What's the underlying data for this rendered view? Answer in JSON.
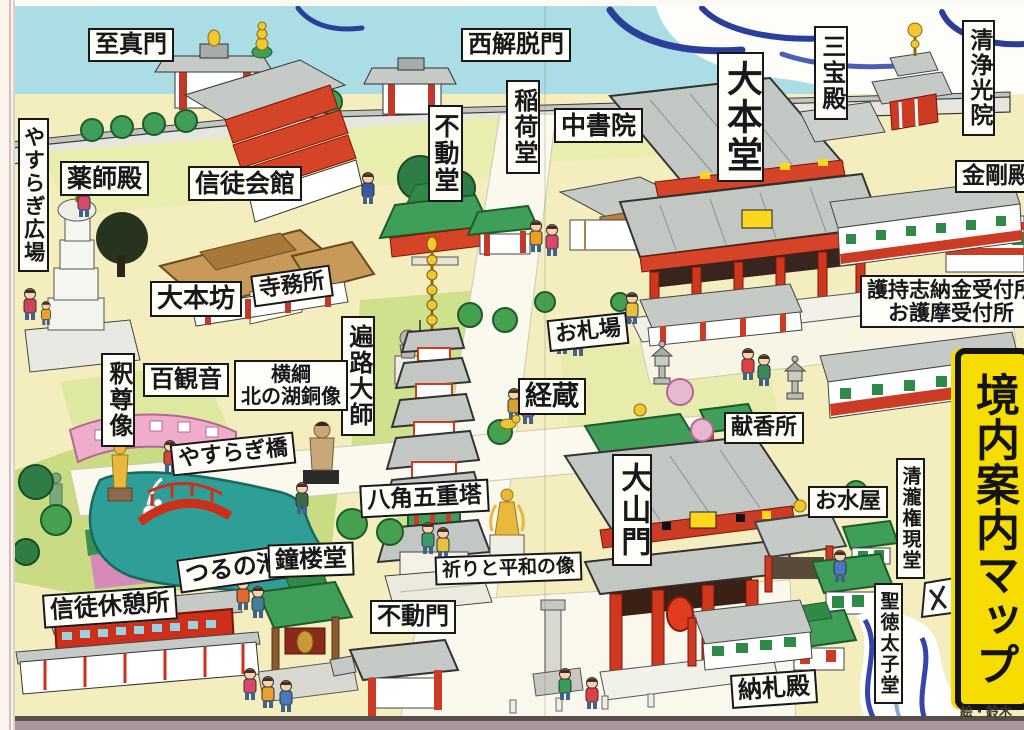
{
  "banner": {
    "text": "境内案内マップ",
    "bg_color": "#f6dc00"
  },
  "credit": "絵・鈴木",
  "colors": {
    "sky_blue": "#aadde6",
    "cloud_navy": "#2b3f9a",
    "ground_cream": "#f4edbe",
    "lawn_green": "#e7ebab",
    "dark_lawn": "#cfe18c",
    "pond_teal": "#2f9e96",
    "building_red": "#d0381e",
    "roof_gray": "#c3c7c3",
    "temple_green_roof": "#3f9e57",
    "wood_tan": "#c89a5a",
    "gold": "#f2c832",
    "banner_yellow": "#f6dc00",
    "pink_corridor": "#efaccb",
    "bottom_strip_mauve": "#a9969c"
  },
  "labels": [
    {
      "id": "shijinmon",
      "t": "至真門",
      "x": 88,
      "y": 28,
      "o": "h",
      "s": 24
    },
    {
      "id": "nishi-gedatsumon",
      "t": "西解脱門",
      "x": 461,
      "y": 28,
      "o": "h",
      "s": 24
    },
    {
      "id": "sanpoden",
      "t": "三宝殿",
      "x": 814,
      "y": 26,
      "o": "v",
      "s": 24
    },
    {
      "id": "shojokoin",
      "t": "清浄光院",
      "x": 962,
      "y": 20,
      "o": "v",
      "s": 23
    },
    {
      "id": "yasuragi-hiroba",
      "t": "やすらぎ広場",
      "x": 18,
      "y": 118,
      "o": "v",
      "s": 21
    },
    {
      "id": "yakushiden",
      "t": "薬師殿",
      "x": 60,
      "y": 161,
      "o": "h",
      "s": 25
    },
    {
      "id": "shintokaikan",
      "t": "信徒会館",
      "x": 188,
      "y": 166,
      "o": "h",
      "s": 25
    },
    {
      "id": "fudodo",
      "t": "不動堂",
      "x": 428,
      "y": 105,
      "o": "v",
      "s": 25
    },
    {
      "id": "inarido",
      "t": "稲荷堂",
      "x": 506,
      "y": 80,
      "o": "v",
      "s": 24
    },
    {
      "id": "chushoin",
      "t": "中書院",
      "x": 554,
      "y": 108,
      "o": "h",
      "s": 25
    },
    {
      "id": "daihondo",
      "t": "大本堂",
      "x": 717,
      "y": 52,
      "o": "v",
      "s": 36
    },
    {
      "id": "kongoden",
      "t": "金剛殿",
      "x": 955,
      "y": 160,
      "o": "h",
      "s": 23
    },
    {
      "id": "daihonbo",
      "t": "大本坊",
      "x": 150,
      "y": 281,
      "o": "h",
      "s": 26
    },
    {
      "id": "jimusho",
      "t": "寺務所",
      "x": 252,
      "y": 270,
      "o": "h",
      "s": 22,
      "r": -8
    },
    {
      "id": "uketsukesho",
      "lines": [
        "護持志納金受付所",
        "お護摩受付所"
      ],
      "x": 860,
      "y": 275,
      "o": "h",
      "s": 21
    },
    {
      "id": "henro-daishi",
      "t": "遍路大師",
      "x": 341,
      "y": 316,
      "o": "v",
      "s": 24
    },
    {
      "id": "ofudaba",
      "t": "お札場",
      "x": 548,
      "y": 316,
      "o": "h",
      "s": 22,
      "r": -6
    },
    {
      "id": "shakusonzo",
      "t": "釈尊像",
      "x": 101,
      "y": 353,
      "o": "v",
      "s": 24
    },
    {
      "id": "hyakkannon",
      "t": "百観音",
      "x": 143,
      "y": 363,
      "o": "h",
      "s": 24
    },
    {
      "id": "yokozuna-kitanoumi",
      "lines": [
        "横綱",
        "北の湖銅像"
      ],
      "x": 234,
      "y": 360,
      "o": "h",
      "s": 20
    },
    {
      "id": "kyozo",
      "t": "経蔵",
      "x": 518,
      "y": 378,
      "o": "h",
      "s": 27
    },
    {
      "id": "kenkosho",
      "t": "献香所",
      "x": 724,
      "y": 412,
      "o": "h",
      "s": 22
    },
    {
      "id": "yasuragibashi",
      "t": "やすらぎ橋",
      "x": 171,
      "y": 438,
      "o": "h",
      "s": 22,
      "r": -6
    },
    {
      "id": "hakkaku-gojunoto",
      "t": "八角五重塔",
      "x": 360,
      "y": 482,
      "o": "h",
      "s": 23,
      "r": -3
    },
    {
      "id": "daisanmon",
      "t": "大山門",
      "x": 612,
      "y": 454,
      "o": "v",
      "s": 30
    },
    {
      "id": "omizuya",
      "t": "お水屋",
      "x": 808,
      "y": 486,
      "o": "h",
      "s": 22
    },
    {
      "id": "seiryu-gongendo",
      "t": "清瀧権現堂",
      "x": 896,
      "y": 458,
      "o": "v",
      "s": 19
    },
    {
      "id": "tsurunoike",
      "t": "つるの池",
      "x": 178,
      "y": 552,
      "o": "h",
      "s": 24,
      "r": -8
    },
    {
      "id": "shorodo",
      "t": "鐘楼堂",
      "x": 268,
      "y": 543,
      "o": "h",
      "s": 24,
      "r": -2
    },
    {
      "id": "inori-to-heiwa-no-zo",
      "t": "祈りと平和の像",
      "x": 435,
      "y": 554,
      "o": "h",
      "s": 19,
      "r": -2
    },
    {
      "id": "shinto-kyukeisho",
      "t": "信徒休憩所",
      "x": 43,
      "y": 590,
      "o": "h",
      "s": 24,
      "r": -4
    },
    {
      "id": "fudomon",
      "t": "不動門",
      "x": 370,
      "y": 600,
      "o": "h",
      "s": 24
    },
    {
      "id": "shotoku-taishido",
      "t": "聖徳太子堂",
      "x": 874,
      "y": 583,
      "o": "v",
      "s": 19
    },
    {
      "id": "nosatsuden",
      "t": "納札殿",
      "x": 731,
      "y": 672,
      "o": "h",
      "s": 24,
      "r": -4
    }
  ]
}
